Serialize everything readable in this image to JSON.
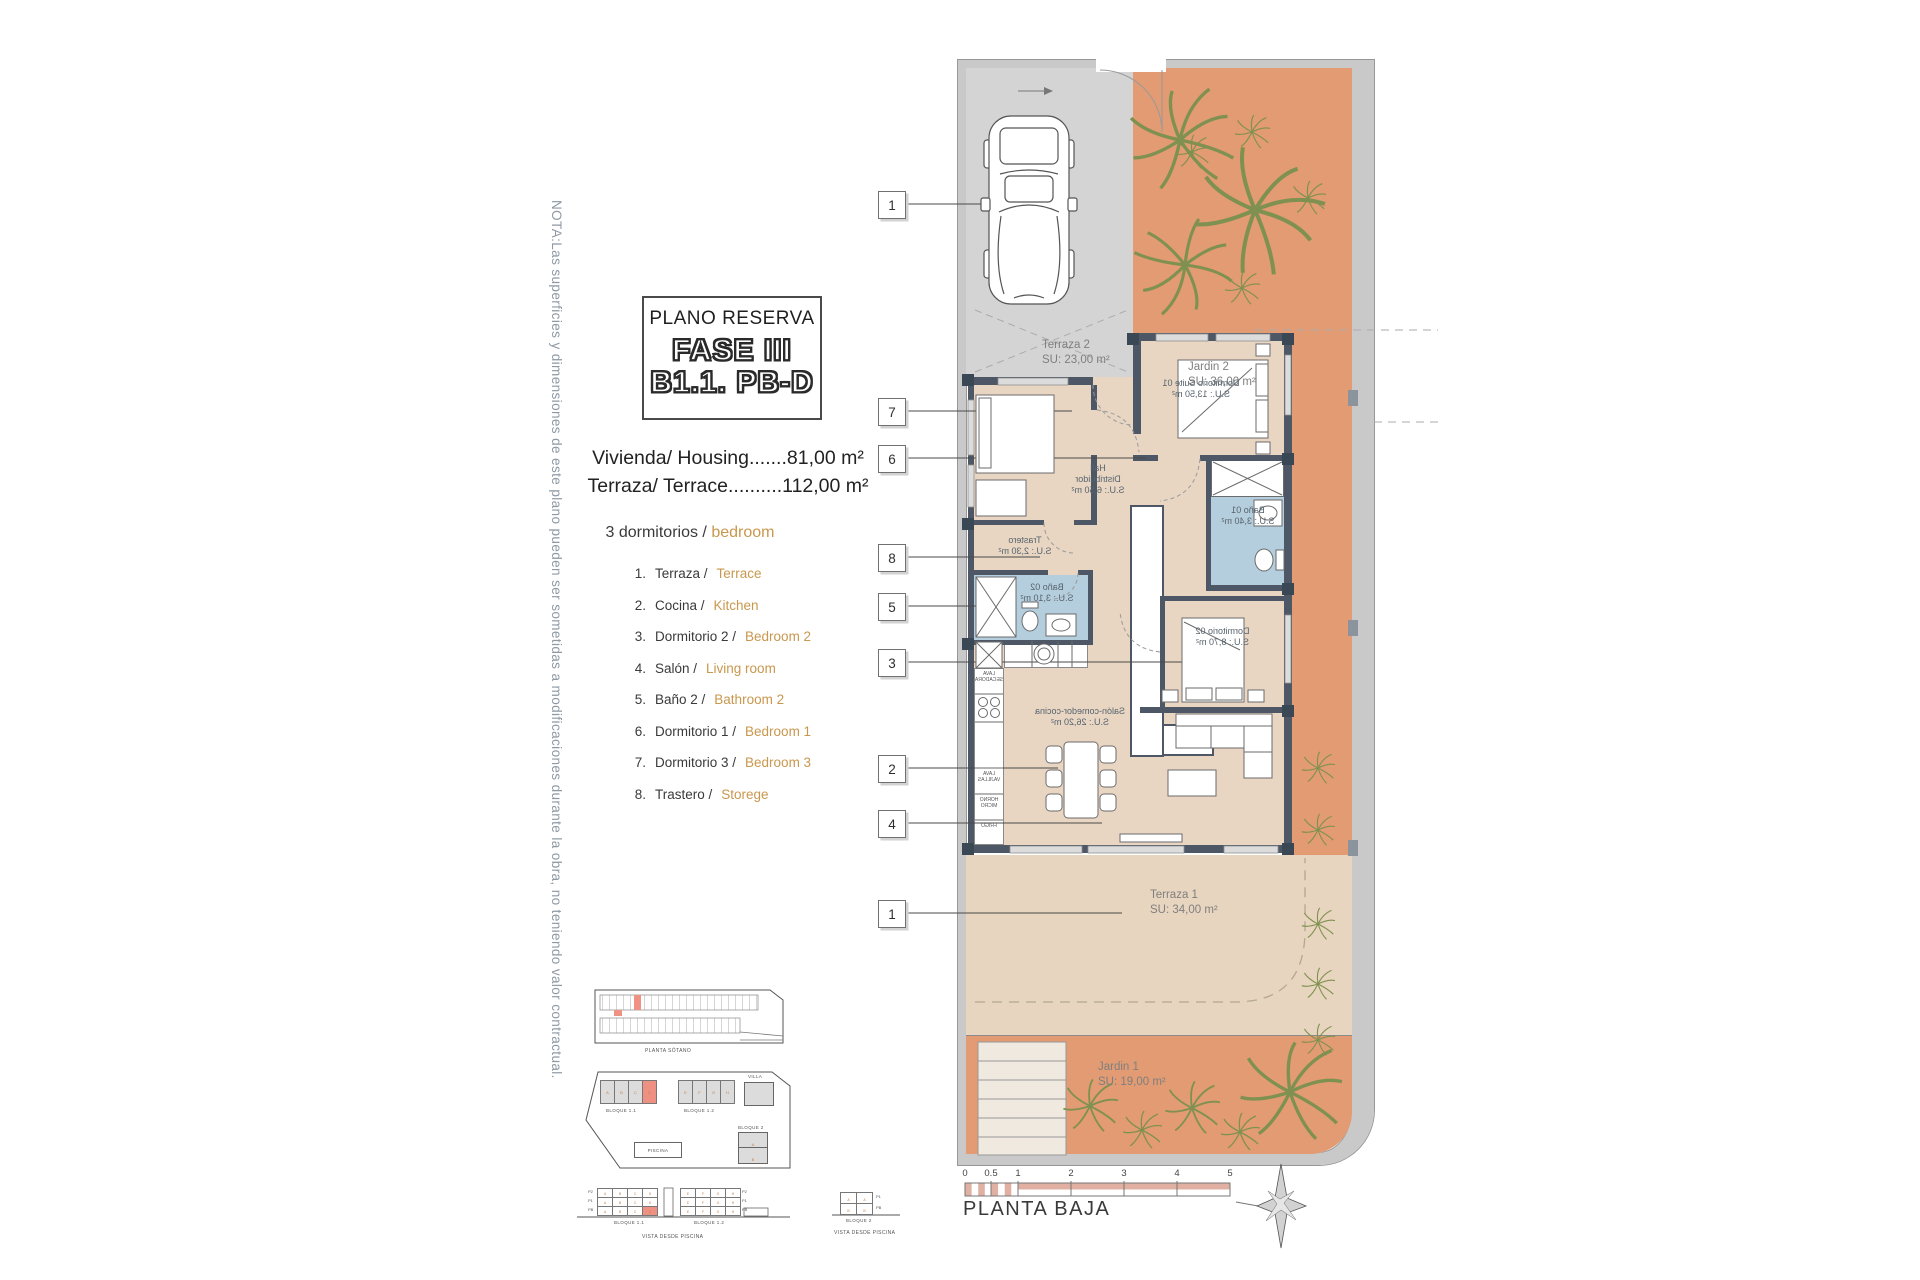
{
  "note": "NOTA:Las superficies y dimensiones de este plano pueden ser sometidas a modificaciones durante la obra, no teniendo valor contractual.",
  "title_block": {
    "subtitle": "PLANO RESERVA",
    "phase": "FASE III",
    "unit": "B1.1. PB-D"
  },
  "summary": {
    "housing": "Vivienda/ Housing.......81,00 m²",
    "terrace": "Terraza/ Terrace..........112,00 m²",
    "bedrooms_es": "3 dormitorios /",
    "bedrooms_en": "bedroom"
  },
  "legend": [
    {
      "num": "1.",
      "es": "Terraza /",
      "en": "Terrace"
    },
    {
      "num": "2.",
      "es": "Cocina /",
      "en": "Kitchen"
    },
    {
      "num": "3.",
      "es": "Dormitorio 2 /",
      "en": "Bedroom 2"
    },
    {
      "num": "4.",
      "es": "Salón /",
      "en": "Living room"
    },
    {
      "num": "5.",
      "es": "Baño 2 /",
      "en": "Bathroom 2"
    },
    {
      "num": "6.",
      "es": "Dormitorio 1 /",
      "en": "Bedroom 1"
    },
    {
      "num": "7.",
      "es": "Dormitorio 3 /",
      "en": "Bedroom 3"
    },
    {
      "num": "8.",
      "es": "Trastero /",
      "en": "Storege"
    }
  ],
  "plan": {
    "callouts": [
      "1",
      "7",
      "6",
      "8",
      "5",
      "3",
      "2",
      "4",
      "1"
    ],
    "outdoor": {
      "terraza2": {
        "name": "Terraza 2",
        "area": "SU: 23,00 m²"
      },
      "jardin2": {
        "name": "Jardin 2",
        "area": "SU: 36,00 m²"
      },
      "terraza1": {
        "name": "Terraza 1",
        "area": "SU: 34,00 m²"
      },
      "jardin1": {
        "name": "Jardin 1",
        "area": "SU: 19,00 m²"
      }
    },
    "rooms": {
      "suite": {
        "name": "Dormitorio Suite 01",
        "area": "S.U.: 13,50 m²"
      },
      "hall": {
        "name": "Hall",
        "name2": "Distribuidor",
        "area": "S.U.: 6,50 m²"
      },
      "trastero": {
        "name": "Trastero",
        "area": "S.U.: 2,30 m²"
      },
      "bano1": {
        "name": "Baño 01",
        "area": "S.U.: 3,40 m²"
      },
      "bano2": {
        "name": "Baño 02",
        "area": "S.U.: 3,10 m²"
      },
      "dorm2": {
        "name": "Dormitorio 02",
        "area": "S.U.: 8,70 m²"
      },
      "salon": {
        "name": "Salón-comedor-cocina",
        "area": "S.U.: 26,20 m²"
      }
    },
    "kitchen": {
      "washer": "LAVA SECADORA",
      "dishwasher": "LAVA VAJILLAS",
      "oven": "HORNO MICRO",
      "fridge": "FRIGO"
    }
  },
  "site": {
    "sotano_label": "PLANTA SÓTANO",
    "bloque11": "BLOQUE 1.1",
    "bloque12": "BLOQUE 1.2",
    "bloque2": "BLOQUE 2",
    "villa": "VILLA",
    "piscina": "PISCINA",
    "b11_units": [
      "A",
      "B",
      "C",
      "D"
    ],
    "b12_units": [
      "E",
      "F",
      "G",
      "H"
    ],
    "b2_units": [
      "A",
      "B"
    ],
    "view_label": "VISTA DESDE PISCINA",
    "floors": [
      "P2",
      "P1",
      "PB"
    ],
    "b2_floors": [
      "P1",
      "PB"
    ]
  },
  "scalebar": {
    "ticks": [
      "0",
      "0.5",
      "1",
      "2",
      "3",
      "4",
      "5"
    ],
    "label": "PLANTA BAJA"
  },
  "colors": {
    "garden": "#e29b72",
    "floor": "#e8d6c3",
    "terrace": "#e8d5bf",
    "parking": "#d4d4d4",
    "wall": "#4d5766",
    "bath": "#b5cedd",
    "highlight": "#ee9183",
    "accent_text": "#c9974d"
  }
}
